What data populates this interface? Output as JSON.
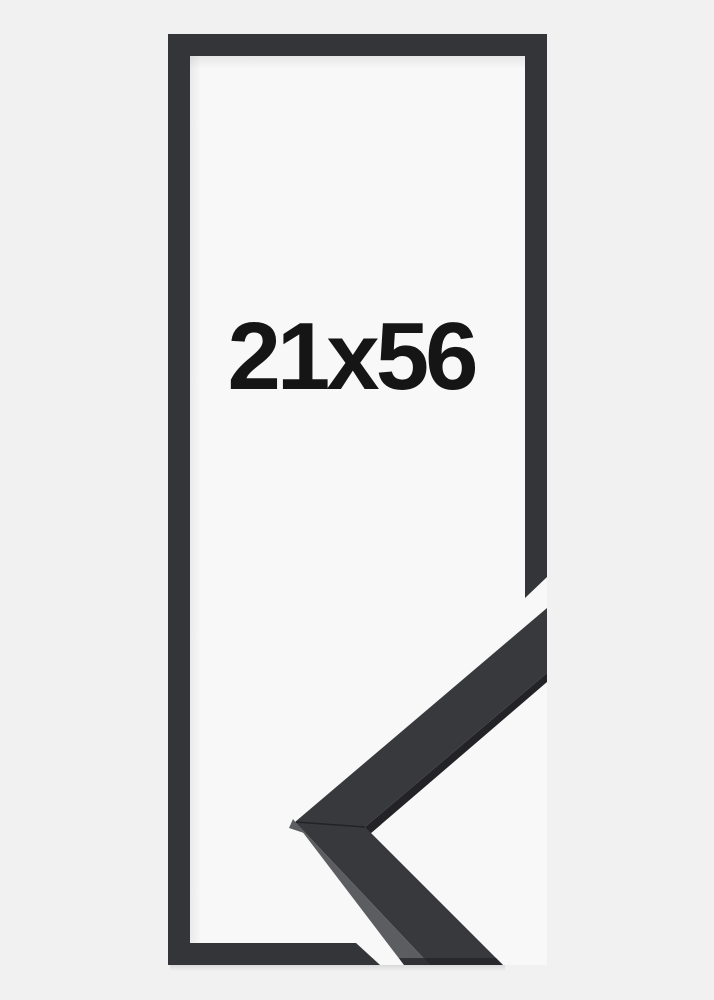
{
  "size_label": "21x56",
  "colors": {
    "background": "#f1f1f2",
    "inner_area": "#f8f8f8",
    "frame_outline": "#343538",
    "molding_face": "#38393c",
    "molding_side": "#5c5d60",
    "molding_under_edge": "#232327",
    "label_text": "#151515"
  }
}
